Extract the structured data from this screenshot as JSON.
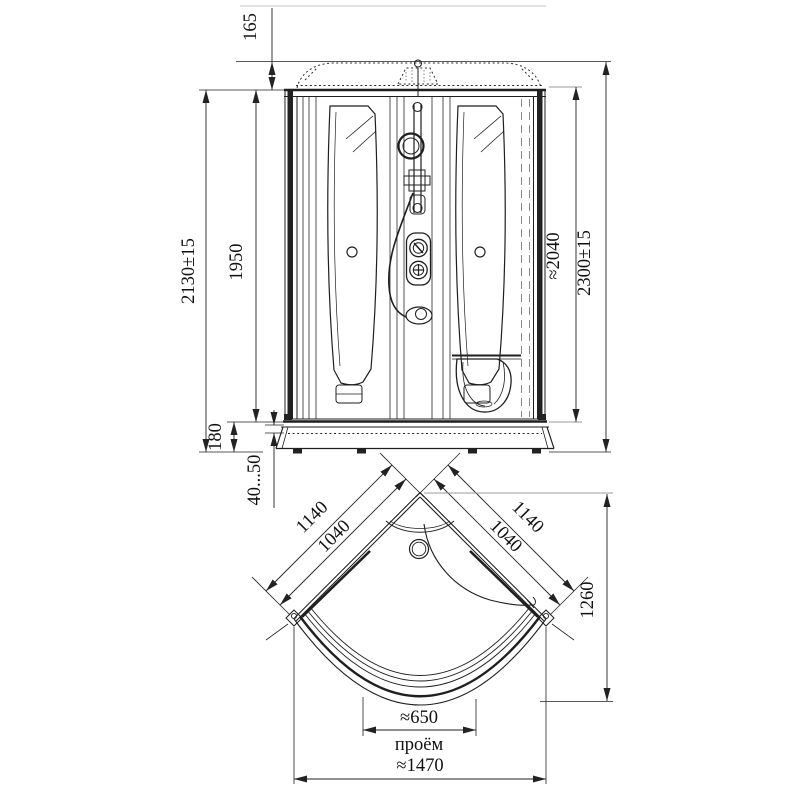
{
  "drawing": {
    "type": "shower-cabin dimensional drawing",
    "colors": {
      "line": "#1f1f1f",
      "gray_aux": "#9b9b9b",
      "background": "#ffffff"
    },
    "front": {
      "dome_height": "165",
      "overall_height_left": "2130±15",
      "body_height": "1950",
      "glass_height": "≈2040",
      "overall_height_right": "2300±15",
      "tray_height": "180",
      "legs_adjust_range": "40...50"
    },
    "plan": {
      "side_outer_left": "1140",
      "side_inner_left": "1040",
      "side_outer_right": "1140",
      "side_inner_right": "1040",
      "depth": "1260",
      "door_opening_width": "≈650",
      "door_opening_caption": "проём",
      "overall_width": "≈1470"
    }
  }
}
